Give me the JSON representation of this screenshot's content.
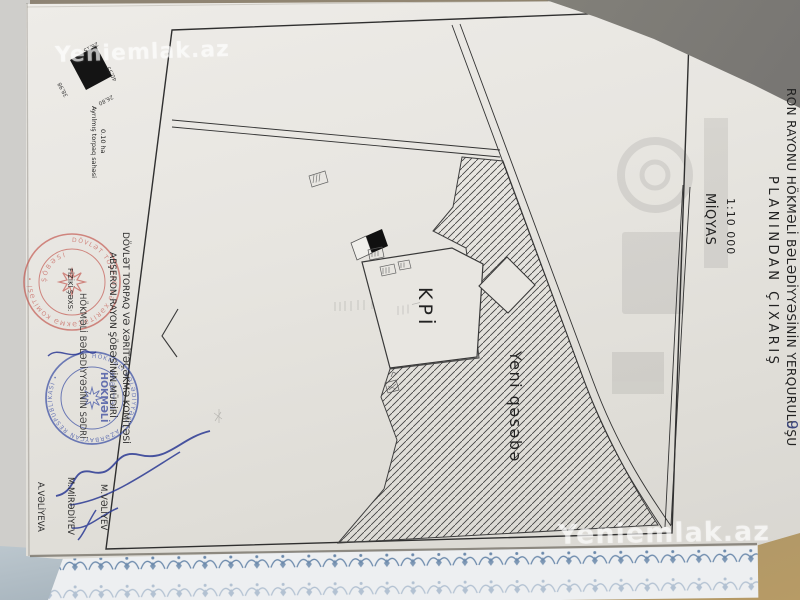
{
  "watermark": {
    "text": "Yeniemlak.az"
  },
  "document": {
    "title_line1": "RON RAYONU HÖKMƏLİ BƏLƏDİYYƏSİNİN YERQURULUŞU",
    "title_line2": "PLANINDAN ÇIXARIŞ",
    "scale_label": "MİQYAS",
    "scale_value": "1:10 000",
    "handwritten_note": "9",
    "allotment": {
      "label": "Ayrılmış torpaq sahəsi",
      "area": "0.10 ha",
      "dimensions": {
        "top": "26,15",
        "right": "40,55",
        "bottom": "26,80",
        "left": "38,98"
      }
    },
    "officials": {
      "line1": "DÖVLƏT TORPAQ VƏ XƏRİTƏÇƏKMƏ KOMİTƏSİ",
      "line2": "ABŞERON RAYON ŞÖBƏSİNİN MÜDİRİ",
      "name1": "M.VƏLİYEV",
      "line3": "HÖKMƏLİ BƏLƏDİYYƏSİNİN SƏDRİ",
      "name2": "M.MİRƏDİYEV",
      "line4": "FİZİKİ ŞƏXS:",
      "name3": "A.VƏLİYEVA"
    },
    "stamps": {
      "red_ring_text": "DÖVLƏT TORPAQ VƏ XƏRİTƏÇƏKMƏ KOMİTƏSİ •",
      "red_inner_text": "ŞÖBƏSİ",
      "blue_ring_text": "HÖKMƏLİ BƏLƏDİYYƏSİ • AZƏRBAYCAN RESPUBLİKASI •",
      "blue_center_text": "HÖKMƏLİ",
      "blue_sub_text": "BƏLƏDİYYƏSİ"
    }
  },
  "map": {
    "label_kpi": "KPİ",
    "label_settlement": "Yeni qəsəbə"
  },
  "colors": {
    "stamp_red": "#c04a42",
    "ink_blue": "#2b3a94",
    "paper": "#e8e6e1",
    "map_line": "#333333"
  }
}
